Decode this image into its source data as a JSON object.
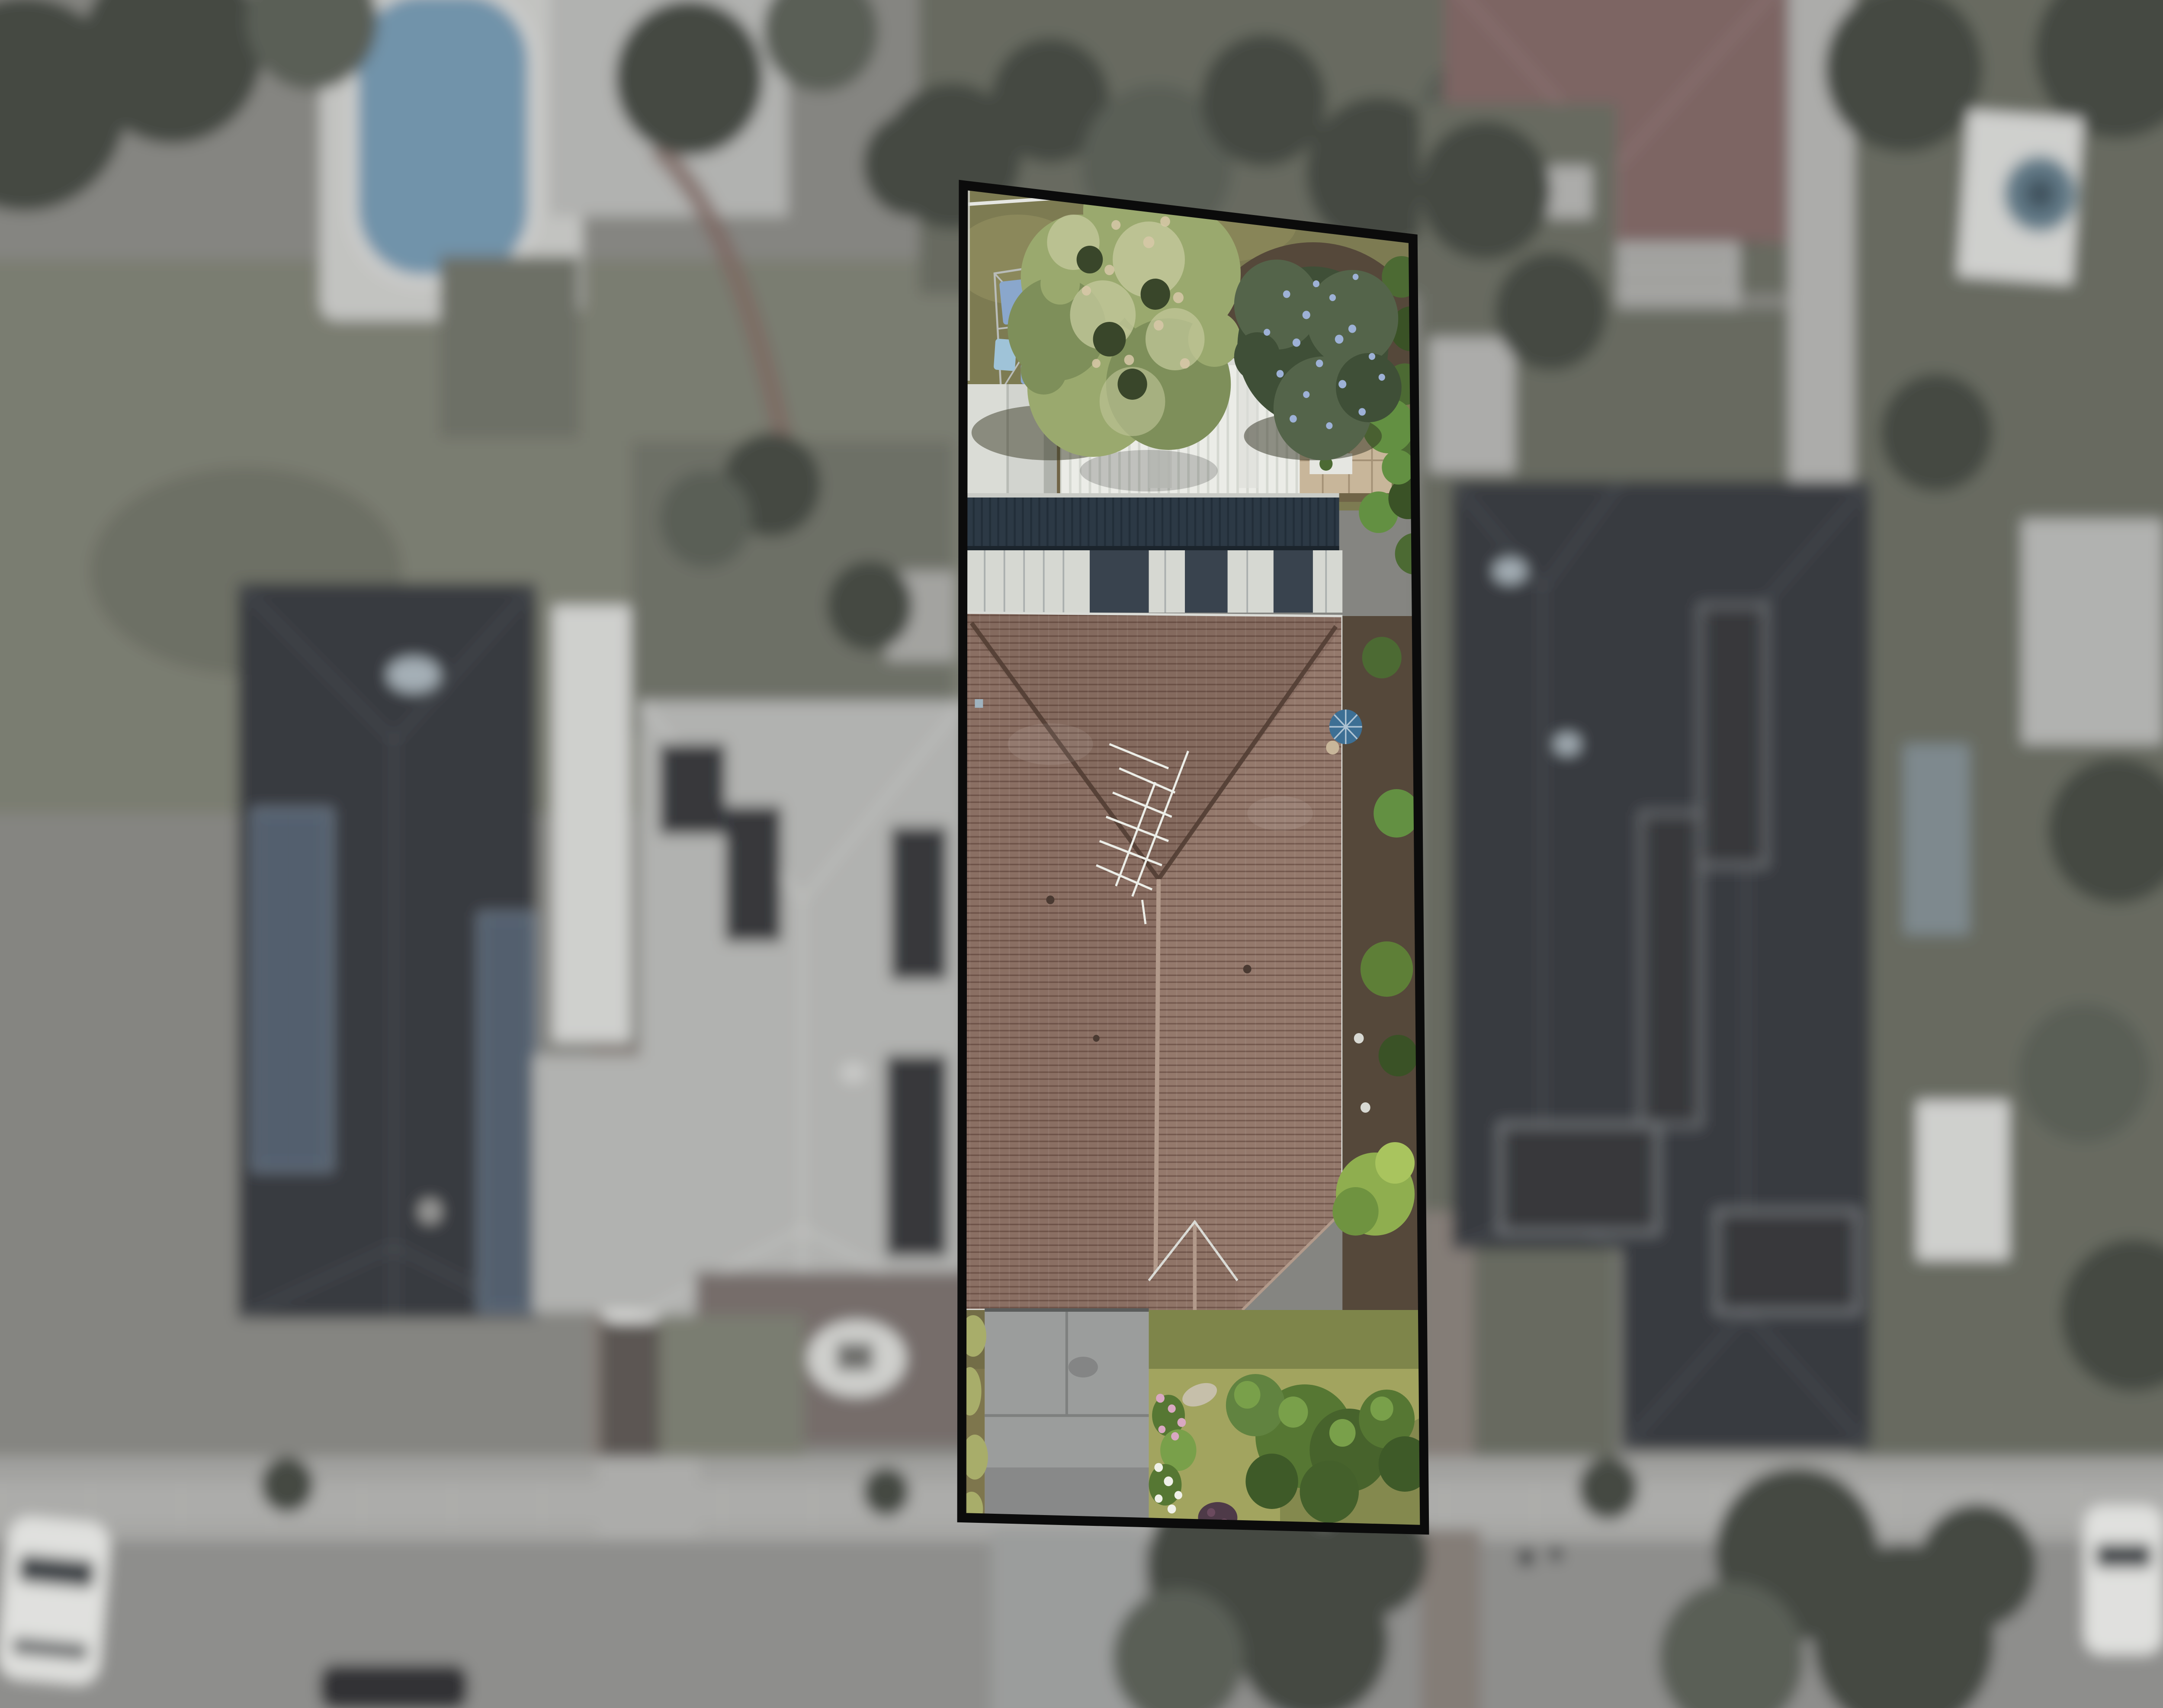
{
  "scene": {
    "title": "Aerial drone photograph of a residential lot outlined in black; the highlighted property is in sharp focus and full colour while the surrounding neighbourhood is blurred and desaturated",
    "type": "real-estate-aerial-photo",
    "highlighted_lot_features": [
      "black boundary outline",
      "back lawn with rotary clothesline and hung washing",
      "large green tree and blue-flowering tree",
      "white corrugated shed roof and grey gable shed",
      "dark navy corrugated garage roof",
      "striped light/dark carport wall band",
      "large brown tiled hip roof with TV antenna",
      "blue patio umbrella at right eave",
      "gabled front porch",
      "grey concrete driveway with expansion joints",
      "front lawn, pink and white flower bed, large green shrubs",
      "side garden strip with hedges and lime-green tree"
    ],
    "surroundings_features": [
      "left neighbour house with dark roof and blue solar panels",
      "pale grey roof house with dark solar panels, white car on driveway",
      "right neighbour dark hip roof with solar arrays",
      "swimming pool top left",
      "red hip roof with pergola top right",
      "teal trampoline far right",
      "street with sidewalk at bottom, parked cars and street trees"
    ]
  },
  "colors": {
    "bg_base": "#85857E",
    "road": "#8E8E8B",
    "sidewalk": "#A2A29E",
    "sidewalk_path": "#ACACA8",
    "curb": "#B5B5B0",
    "muted_lawn": "#7A7E66",
    "muted_lawn_dark": "#676C58",
    "muted_garden": "#6C7060",
    "muted_tree": "#414B3B",
    "muted_tree_light": "#566050",
    "dark_roof": "#363C43",
    "dark_roof_ridge": "#4D545C",
    "pale_roof": "#B1B2AE",
    "pale_roof_ridge": "#C6C7C3",
    "white_structure": "#CFD0CB",
    "solar_blue": "#3D5872",
    "solar_dark": "#2B3036",
    "pool_water": "#4F96BC",
    "pool_deck": "#C2C3BF",
    "red_roof": "#8A5F5D",
    "red_roof_ridge": "#9D7270",
    "pergola": "#A7A7A2",
    "trampoline": "#49788F",
    "brick_drive": "#897B72",
    "drive_shadow": "#5E564E",
    "mulch": "#7B6B66",
    "ornament_white": "#CFD0CA",
    "car_white": "#E0E1DC",
    "car_glass": "#3E454B",
    "car_dark": "#303338",
    "car_teal": "#7E98AC",
    "boundary": "#0B0B0B",
    "lawn_back": "#7D7B52",
    "lawn_back_light": "#8F8C5E",
    "soil": "#6F6246",
    "soil_dark": "#55483A",
    "lawn_front": "#A2A45F",
    "lawn_front_shadow": "#6F7842",
    "tree_base": "#7E8F5A",
    "tree_mid": "#9AA96E",
    "tree_light": "#C2C79A",
    "tree_pink": "#D8C8A8",
    "tree_dark": "#39462A",
    "bluetree_base": "#3F4F37",
    "bluetree_mid": "#54644A",
    "bluetree_speckle": "#9DB1D6",
    "hedge": "#4C6A33",
    "hedge_light": "#639042",
    "hedge_dark": "#3A5226",
    "shed_white": "#EBECE7",
    "shed_white_rib": "#D5D8D1",
    "shed_grey": "#D2D4CF",
    "shed_grey_shadow": "#AFB2AC",
    "paving_tan": "#C8B69A",
    "flower_red": "#A83838",
    "garage_navy": "#2C3945",
    "garage_navy_rib": "#222E39",
    "wall_light": "#D6D8D2",
    "wall_dark": "#39434E",
    "roof_brown": "#8A6F63",
    "roof_brown_light": "#A08478",
    "roof_brown_dark": "#7E655A",
    "roof_ridge_cap": "#B29A8B",
    "roof_valley": "#503C32",
    "gutter_white": "#DADBD6",
    "antenna": "#ECEEE8",
    "umbrella": "#3D6F94",
    "drive_grey": "#9B9D9C",
    "drive_joint": "#7E807F",
    "grass_tuft": "#A8AD6A",
    "shrub": "#567733",
    "shrub_dark": "#3E5A28",
    "shrub_light": "#79A04A",
    "flower_pink": "#D9A8C2",
    "flower_white": "#EFF0E8",
    "purple_shrub": "#4E3A48",
    "planter_white": "#E5E6E1",
    "planter_red": "#9E2F3C",
    "clothes_blue": "#8AA7CC",
    "clothes_lightblue": "#9FC3D8",
    "clothes_navy": "#57719B",
    "line_grey": "#B9BCB9",
    "path_pebble": "#C6BFAA"
  }
}
